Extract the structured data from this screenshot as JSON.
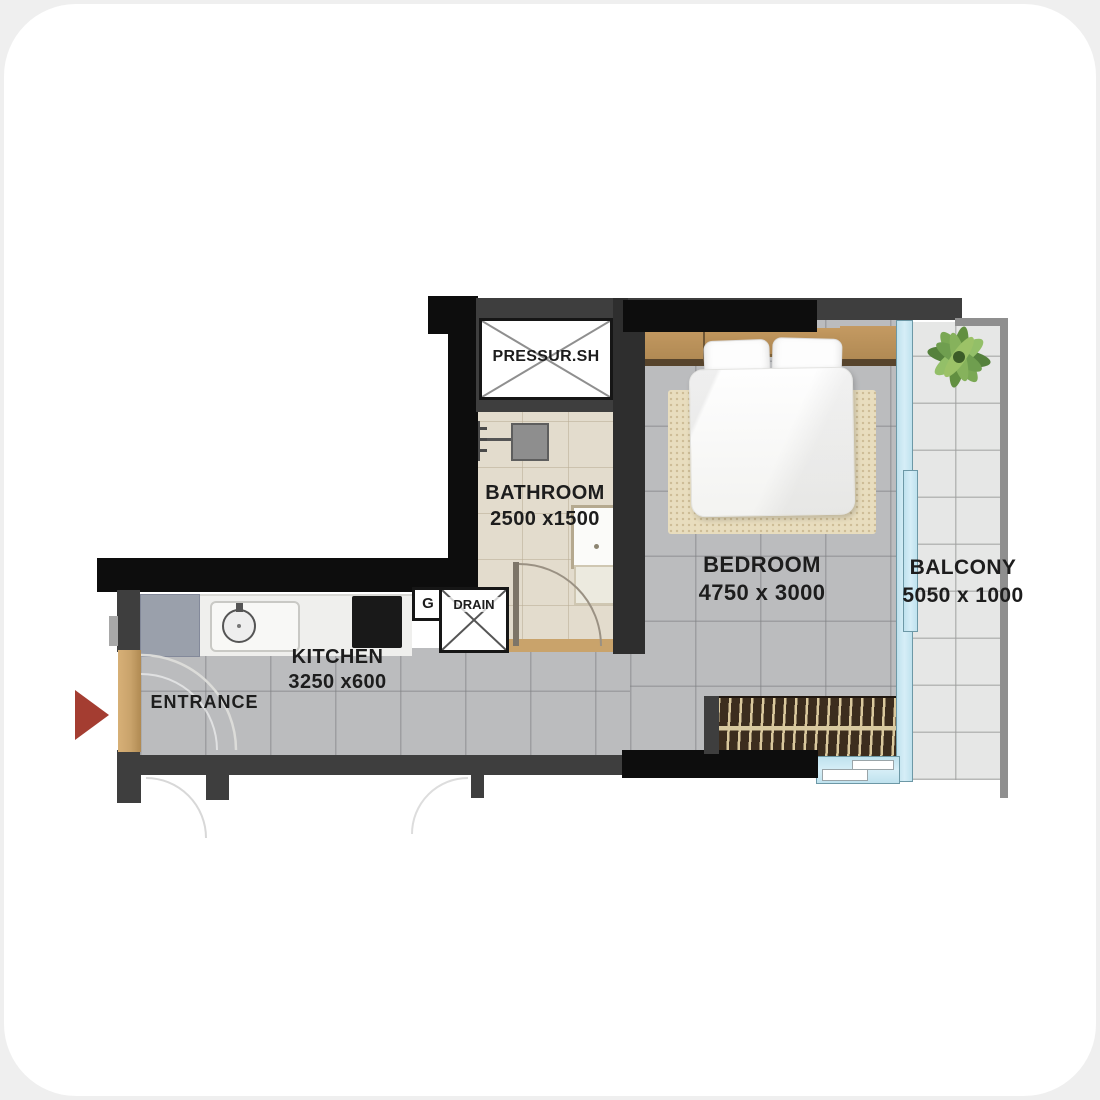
{
  "plan": {
    "rooms": {
      "bathroom": {
        "label": "BATHROOM",
        "dims": "2500 x1500"
      },
      "bedroom": {
        "label": "BEDROOM",
        "dims": "4750 x 3000"
      },
      "balcony": {
        "label": "BALCONY",
        "dims": "5050 x 1000"
      },
      "kitchen": {
        "label": "KITCHEN",
        "dims": "3250 x600"
      },
      "entrance": {
        "label": "ENTRANCE"
      }
    },
    "features": {
      "pressure_shaft": {
        "label": "PRESSUR.SH"
      },
      "gas_meter": {
        "label": "G"
      },
      "drain": {
        "label": "DRAIN"
      }
    },
    "colors": {
      "wall_black": "#0d0d0d",
      "wall_dark": "#3e3e3e",
      "wall_light": "#8f8f8f",
      "floor_gray": "#bbbcbe",
      "floor_beige": "#e3dccd",
      "floor_balcony": "#e6e7e6",
      "rug": "#e8ddbe",
      "wood": "#c9a36b",
      "glass": "#d6eef7",
      "glass_border": "#6d98a6",
      "arrow_red": "#a43d31",
      "bench": "#3c2d1e",
      "counter": "#efefed",
      "fridge": "#9aa0ab",
      "cooktop": "#191919"
    }
  }
}
